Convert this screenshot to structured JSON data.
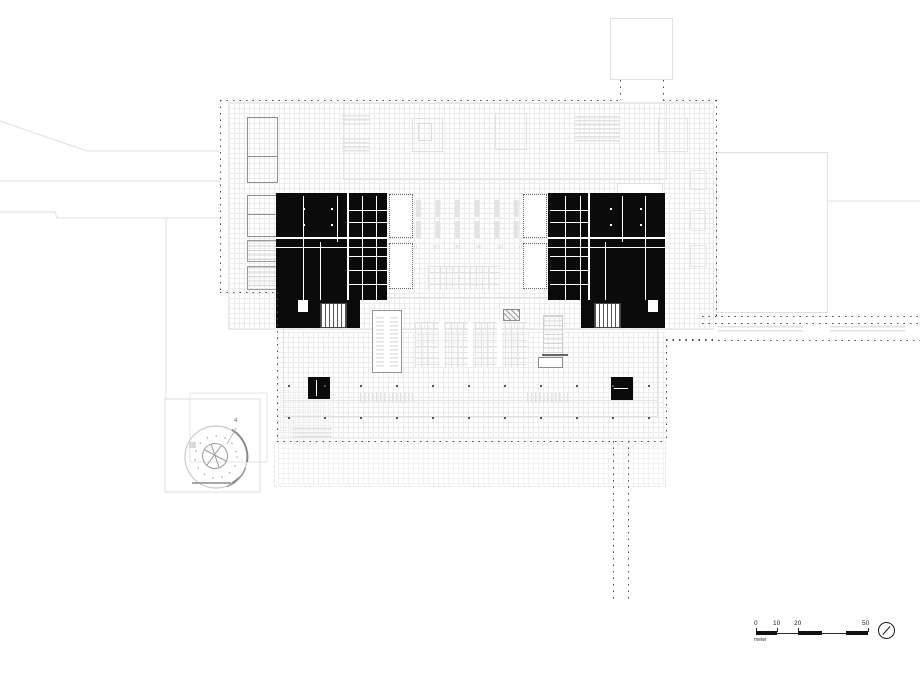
{
  "plan": {
    "detail": {
      "label": "4"
    },
    "atrium": {
      "markers": [
        "()",
        "(X)",
        "(X)",
        "(X)",
        "(X)",
        "()"
      ]
    },
    "scale_bar": {
      "n0": "0",
      "n10": "10",
      "n20": "20",
      "n50": "50",
      "unit": "meter"
    },
    "colors": {
      "poche": "#0b0b0b",
      "boundary_dots": "#4a4a4a",
      "light_line": "#e0e0e0",
      "mid_line": "#909090"
    }
  }
}
